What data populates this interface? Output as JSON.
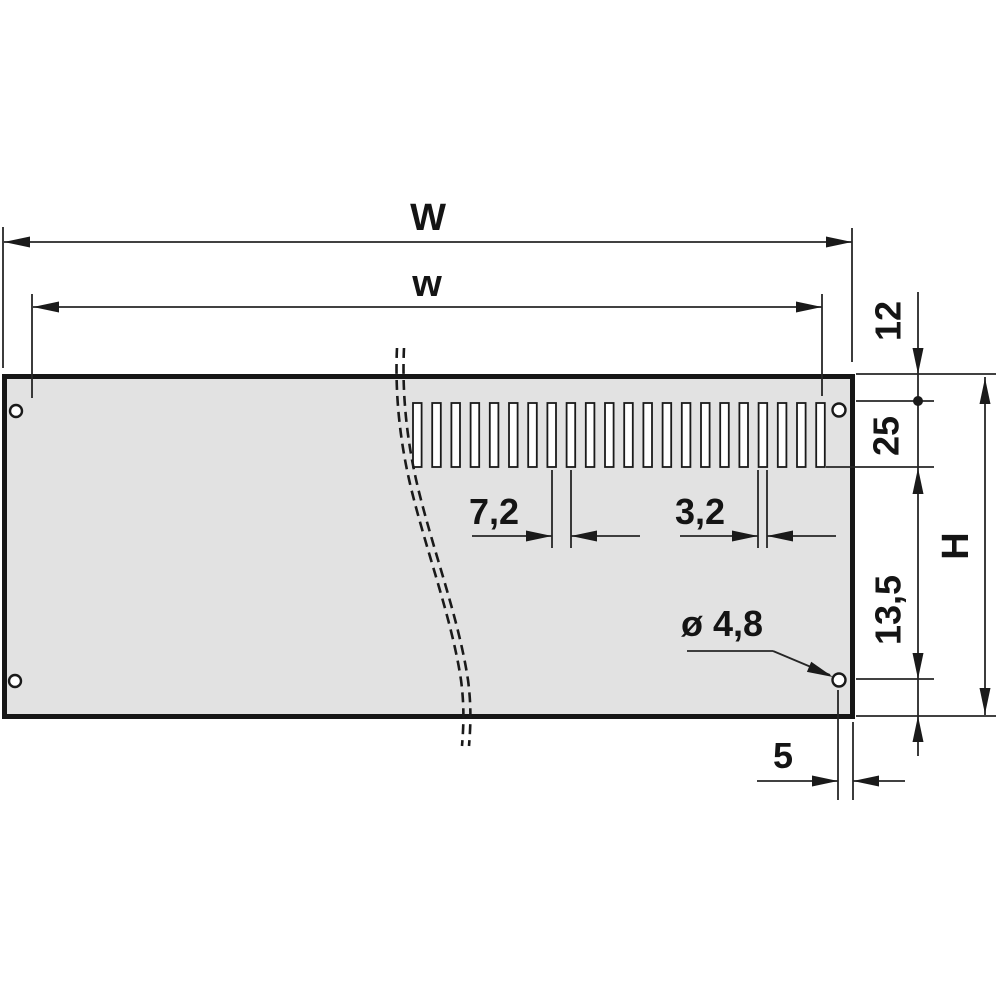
{
  "drawing": {
    "title": "vented front panel - rear view dimension drawing",
    "colors": {
      "background": "#ffffff",
      "panel_fill": "#e2e2e2",
      "line": "#1a1a1a"
    },
    "panel": {
      "slot_count": 22,
      "mounting_hole_count": 4
    },
    "labels": {
      "overall_width": "W",
      "aperture_width": "w",
      "top_to_hole_center": "12",
      "hole_center_to_slot_end": "25",
      "overall_height": "H",
      "hole_center_to_bottom_edge": "13,5",
      "slot_pitch": "7,2",
      "slot_width": "3,2",
      "hole_diameter": "ø 4,8",
      "hole_center_to_side_edge": "5"
    }
  }
}
